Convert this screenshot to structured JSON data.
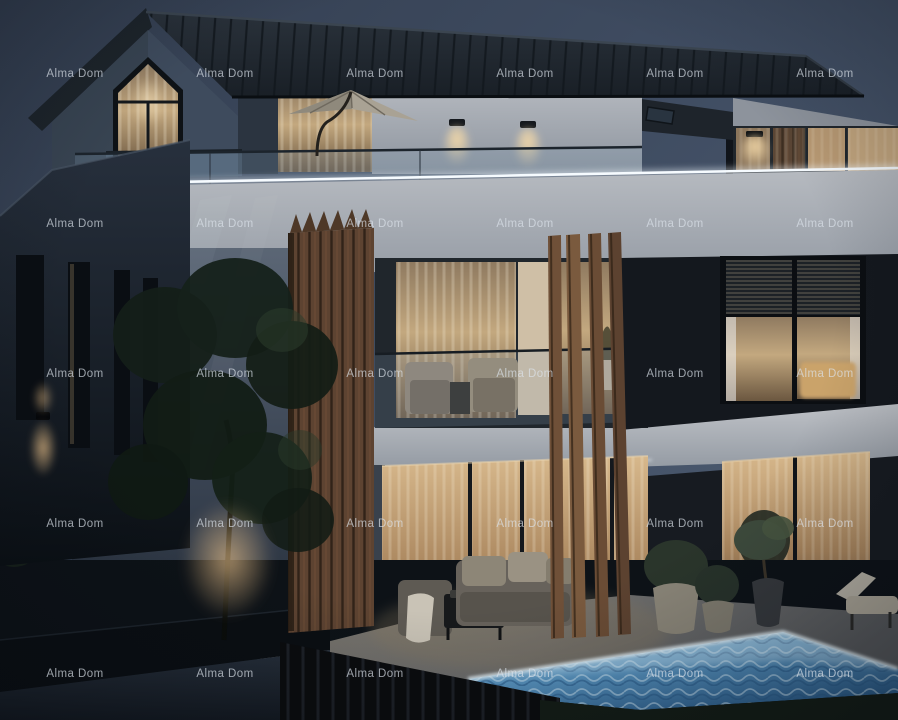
{
  "meta": {
    "type": "architectural-dusk-rendering",
    "subject": "Modern two-storey villa at dusk with rooftop terrace, wood slat accents, illuminated swimming pool and garden",
    "width": 898,
    "height": 720
  },
  "watermark": {
    "text": "Alma Dom",
    "font_size_px": 11.5,
    "color": "#dde4ec",
    "opacity": 0.68,
    "grid": {
      "columns": 6,
      "rows": 5,
      "origin_x": 75,
      "origin_y": 74,
      "step_x": 150,
      "step_y": 150
    }
  },
  "palette": {
    "sky_top": "#333e50",
    "sky_mid": "#3f4c61",
    "sky_bottom": "#4d5c72",
    "roof_dark": "#20262d",
    "gable_wall": "#3e4b5d",
    "white_wall": "#99a0aa",
    "white_wall_shadow": "#4d5868",
    "dark_facade": "#14181e",
    "window_warm": "#c3a87f",
    "door_warm": "#d7b88c",
    "curtain": "#e8dcc4",
    "wood": "#6a4c36",
    "wood_dark": "#382a1f",
    "led_strip": "#eef5fb",
    "pool_bright": "#bfe2f2",
    "pool_mid": "#5d9ac6",
    "pool_deep": "#2c5f8f",
    "terrace_stone": "#6e6e6d",
    "foliage": "#1c271f",
    "ground_dark": "#0d1217",
    "road": "#222a35",
    "lamp_glow": "#edc48c"
  },
  "scene": {
    "visible_elements": [
      "dusk sky",
      "gabled attic with pentagon picture window",
      "standing-seam metal roof",
      "roof skylight",
      "rooftop terrace with cantilever parasol",
      "glass balustrades with LED strip lighting",
      "facade wall lamps",
      "vertical wood slat column",
      "freestanding wood fins",
      "balcony lounge chairs",
      "bedroom windows with venetian blinds",
      "ground floor glass sliding doors",
      "outdoor sofa set with coffee table",
      "illuminated swimming pool",
      "woven planters with shrubs",
      "olive tree in vase",
      "sun lounger",
      "garden tree",
      "boundary wall and driveway"
    ]
  }
}
